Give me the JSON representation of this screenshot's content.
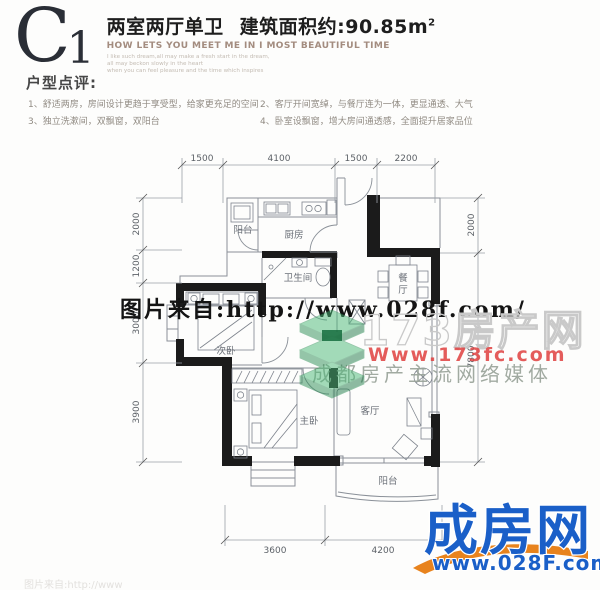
{
  "header": {
    "plan_code_letter": "C",
    "plan_code_number": "1",
    "layout_name": "两室两厅单卫",
    "area_text": "建筑面积约:90.85m",
    "area_sup": "2",
    "subtitle_en": "HOW LETS YOU MEET ME IN I MOST BEAUTIFUL TIME",
    "fineprint": [
      "I like such dream,all may make a fresh start in the dream,",
      "all may beckon slowly in the heart",
      "when you can feel pleasure and the time which inspires"
    ]
  },
  "comments": {
    "title": "户型点评:",
    "items": [
      "1、舒适两房，房间设计更趋于享受型，给家更充足的空间",
      "2、客厅开间宽绰，与餐厅连为一体，更显通透、大气",
      "3、独立洗漱间，双飘窗，双阳台",
      "4、卧室设飘窗，增大房间通透感，全面提升居家品位"
    ]
  },
  "floorplan": {
    "rooms": {
      "balcony_top": "阳台",
      "kitchen": "厨房",
      "bathroom": "卫生间",
      "dining": [
        "餐",
        "厅"
      ],
      "second_bedroom": "次卧",
      "master_bedroom": "主卧",
      "living_room": "客厅",
      "balcony_bottom": "阳台"
    },
    "dimensions": {
      "top": [
        "1500",
        "4100",
        "1500",
        "2200"
      ],
      "left": [
        "2000",
        "1200",
        "3000",
        "3900"
      ],
      "right": [
        "2000",
        "7800"
      ],
      "bottom": [
        "3600",
        "4200"
      ]
    }
  },
  "watermarks": {
    "source_url_text": "图片来自:http://www.028f.com/",
    "outline_text": "173房产网",
    "red_url": "Www.173fc.com",
    "slogan": "成都房产主流网络媒体",
    "bottom_partial": "图片来自:http://www",
    "logo_name": "成房网",
    "logo_url": "www.028F.com"
  },
  "colors": {
    "logo_blue": "#1a5fc8",
    "logo_orange": "#e8831d",
    "watermark_red": "#e04040",
    "watermark_green": "#35a362"
  }
}
